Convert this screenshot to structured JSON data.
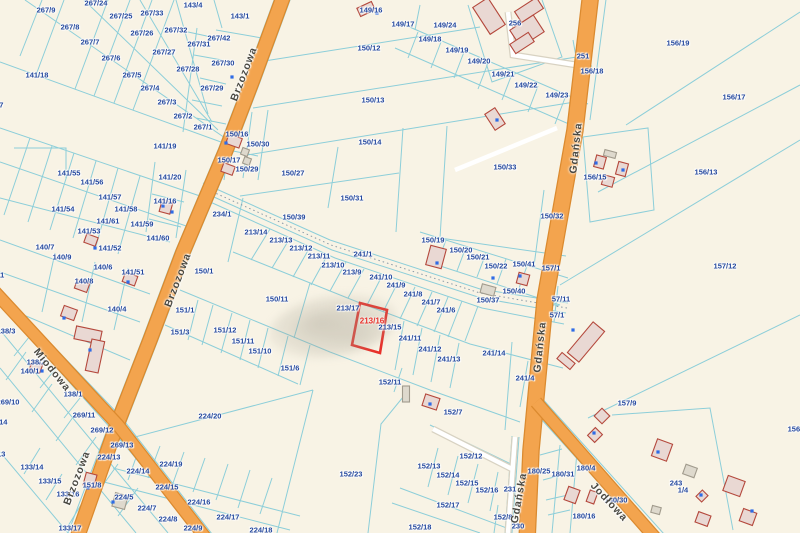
{
  "map": {
    "colors": {
      "background": "#f8f3e5",
      "boundary_line": "#8cced9",
      "parcel_label": "#24489e",
      "street_label": "#4a4942",
      "road_fill": "#f3a44e",
      "road_edge": "#db8a2f",
      "highlight": "#e8312a",
      "building_fill": "#e9d8d3",
      "building_stroke": "#b4483c",
      "shed_fill": "#ded9cd",
      "shed_stroke": "#a19b8d",
      "address_dot": "#2e6be6"
    },
    "highlight": {
      "label": "213/16",
      "points": "360,303 387,310 380,353 352,345",
      "label_x": 372,
      "label_y": 321
    },
    "streets": [
      {
        "t": "Brzozowa",
        "x": 244,
        "y": 74,
        "r": -69
      },
      {
        "t": "Brzozowa",
        "x": 178,
        "y": 280,
        "r": -69
      },
      {
        "t": "Brzozowa",
        "x": 77,
        "y": 478,
        "r": -69
      },
      {
        "t": "Gdańska",
        "x": 576,
        "y": 148,
        "r": -84
      },
      {
        "t": "Gdańska",
        "x": 540,
        "y": 347,
        "r": -84
      },
      {
        "t": "Gdańska",
        "x": 519,
        "y": 498,
        "r": -80
      },
      {
        "t": "Miodowa",
        "x": 52,
        "y": 370,
        "r": 51
      },
      {
        "t": "Jodłowa",
        "x": 609,
        "y": 502,
        "r": 47
      }
    ],
    "roads": [
      {
        "name": "Brzozowa",
        "path": "M285,-8 L252,82 L226,150 L183,252 L150,340 L115,430 L76,541",
        "width": 13
      },
      {
        "name": "Gdańska",
        "path": "M591,-8 L575,130 L545,300 L531,450 L527,541",
        "width": 15
      },
      {
        "name": "Miodowa",
        "path": "M-6,291 L118,425 L208,541",
        "width": 11
      },
      {
        "name": "Jodłowa",
        "path": "M536,402 L658,541",
        "width": 11
      }
    ],
    "parcel_labels": [
      {
        "t": "267/24",
        "x": 96,
        "y": 3
      },
      {
        "t": "267/9",
        "x": 46,
        "y": 10
      },
      {
        "t": "267/33",
        "x": 152,
        "y": 13
      },
      {
        "t": "267/25",
        "x": 121,
        "y": 16
      },
      {
        "t": "267/8",
        "x": 70,
        "y": 27
      },
      {
        "t": "267/32",
        "x": 176,
        "y": 30
      },
      {
        "t": "267/26",
        "x": 142,
        "y": 33
      },
      {
        "t": "267/7",
        "x": 90,
        "y": 42
      },
      {
        "t": "267/27",
        "x": 164,
        "y": 52
      },
      {
        "t": "267/6",
        "x": 111,
        "y": 58
      },
      {
        "t": "267/28",
        "x": 188,
        "y": 69
      },
      {
        "t": "267/5",
        "x": 132,
        "y": 75
      },
      {
        "t": "267/4",
        "x": 150,
        "y": 88
      },
      {
        "t": "267/3",
        "x": 167,
        "y": 102
      },
      {
        "t": "267/2",
        "x": 183,
        "y": 116
      },
      {
        "t": "143/4",
        "x": 193,
        "y": 5
      },
      {
        "t": "143/1",
        "x": 240,
        "y": 16
      },
      {
        "t": "267/42",
        "x": 219,
        "y": 38
      },
      {
        "t": "267/31",
        "x": 199,
        "y": 44
      },
      {
        "t": "267/30",
        "x": 223,
        "y": 63
      },
      {
        "t": "267/29",
        "x": 212,
        "y": 88
      },
      {
        "t": "267/1",
        "x": 203,
        "y": 127
      },
      {
        "t": "141/18",
        "x": 37,
        "y": 75
      },
      {
        "t": "141/27",
        "x": -8,
        "y": 105
      },
      {
        "t": "149/16",
        "x": 371,
        "y": 10
      },
      {
        "t": "150/12",
        "x": 369,
        "y": 48
      },
      {
        "t": "150/13",
        "x": 373,
        "y": 100
      },
      {
        "t": "150/14",
        "x": 370,
        "y": 142
      },
      {
        "t": "149/17",
        "x": 403,
        "y": 24
      },
      {
        "t": "149/24",
        "x": 445,
        "y": 25
      },
      {
        "t": "149/18",
        "x": 430,
        "y": 39
      },
      {
        "t": "149/19",
        "x": 457,
        "y": 50
      },
      {
        "t": "149/20",
        "x": 479,
        "y": 61
      },
      {
        "t": "149/21",
        "x": 503,
        "y": 74
      },
      {
        "t": "149/22",
        "x": 526,
        "y": 85
      },
      {
        "t": "149/23",
        "x": 557,
        "y": 95
      },
      {
        "t": "256",
        "x": 515,
        "y": 23
      },
      {
        "t": "251",
        "x": 583,
        "y": 56
      },
      {
        "t": "156/18",
        "x": 592,
        "y": 71
      },
      {
        "t": "156/19",
        "x": 678,
        "y": 43
      },
      {
        "t": "156/17",
        "x": 734,
        "y": 97
      },
      {
        "t": "156/13",
        "x": 706,
        "y": 172
      },
      {
        "t": "156/15",
        "x": 595,
        "y": 177
      },
      {
        "t": "157/12",
        "x": 725,
        "y": 266
      },
      {
        "t": "157/1",
        "x": 551,
        "y": 268
      },
      {
        "t": "150/16",
        "x": 237,
        "y": 134
      },
      {
        "t": "150/30",
        "x": 258,
        "y": 144
      },
      {
        "t": "150/17",
        "x": 229,
        "y": 160
      },
      {
        "t": "150/29",
        "x": 247,
        "y": 169
      },
      {
        "t": "150/27",
        "x": 293,
        "y": 173
      },
      {
        "t": "150/31",
        "x": 352,
        "y": 198
      },
      {
        "t": "150/33",
        "x": 505,
        "y": 167
      },
      {
        "t": "150/32",
        "x": 552,
        "y": 216
      },
      {
        "t": "234/1",
        "x": 222,
        "y": 214
      },
      {
        "t": "150/39",
        "x": 294,
        "y": 217
      },
      {
        "t": "150/1",
        "x": 204,
        "y": 271
      },
      {
        "t": "141/19",
        "x": 165,
        "y": 146
      },
      {
        "t": "141/55",
        "x": 69,
        "y": 173
      },
      {
        "t": "141/56",
        "x": 92,
        "y": 182
      },
      {
        "t": "141/57",
        "x": 110,
        "y": 197
      },
      {
        "t": "141/58",
        "x": 126,
        "y": 209
      },
      {
        "t": "141/20",
        "x": 170,
        "y": 177
      },
      {
        "t": "141/16",
        "x": 165,
        "y": 201
      },
      {
        "t": "141/54",
        "x": 63,
        "y": 209
      },
      {
        "t": "141/61",
        "x": 108,
        "y": 221
      },
      {
        "t": "141/59",
        "x": 142,
        "y": 224
      },
      {
        "t": "141/60",
        "x": 158,
        "y": 238
      },
      {
        "t": "141/53",
        "x": 89,
        "y": 231
      },
      {
        "t": "141/52",
        "x": 110,
        "y": 248
      },
      {
        "t": "140/7",
        "x": 45,
        "y": 247
      },
      {
        "t": "140/9",
        "x": 62,
        "y": 257
      },
      {
        "t": "140/6",
        "x": 103,
        "y": 267
      },
      {
        "t": "141/51",
        "x": 133,
        "y": 272
      },
      {
        "t": "140/8",
        "x": 84,
        "y": 281
      },
      {
        "t": "140/11",
        "x": -7,
        "y": 275
      },
      {
        "t": "213/14",
        "x": 256,
        "y": 232
      },
      {
        "t": "213/13",
        "x": 281,
        "y": 240
      },
      {
        "t": "213/12",
        "x": 301,
        "y": 248
      },
      {
        "t": "213/11",
        "x": 319,
        "y": 256
      },
      {
        "t": "213/10",
        "x": 333,
        "y": 265
      },
      {
        "t": "213/9",
        "x": 352,
        "y": 272
      },
      {
        "t": "241/1",
        "x": 363,
        "y": 254
      },
      {
        "t": "241/10",
        "x": 381,
        "y": 277
      },
      {
        "t": "241/9",
        "x": 396,
        "y": 285
      },
      {
        "t": "241/8",
        "x": 413,
        "y": 294
      },
      {
        "t": "241/7",
        "x": 431,
        "y": 302
      },
      {
        "t": "241/6",
        "x": 446,
        "y": 310
      },
      {
        "t": "150/19",
        "x": 433,
        "y": 240
      },
      {
        "t": "150/20",
        "x": 461,
        "y": 250
      },
      {
        "t": "150/21",
        "x": 478,
        "y": 257
      },
      {
        "t": "150/22",
        "x": 496,
        "y": 266
      },
      {
        "t": "150/41",
        "x": 524,
        "y": 264
      },
      {
        "t": "150/37",
        "x": 488,
        "y": 300
      },
      {
        "t": "150/40",
        "x": 514,
        "y": 291
      },
      {
        "t": "57/11",
        "x": 561,
        "y": 299
      },
      {
        "t": "57/1",
        "x": 557,
        "y": 315
      },
      {
        "t": "241/4",
        "x": 525,
        "y": 378
      },
      {
        "t": "150/11",
        "x": 277,
        "y": 299
      },
      {
        "t": "213/17",
        "x": 348,
        "y": 308
      },
      {
        "t": "213/15",
        "x": 390,
        "y": 327
      },
      {
        "t": "241/11",
        "x": 410,
        "y": 338
      },
      {
        "t": "241/12",
        "x": 430,
        "y": 349
      },
      {
        "t": "241/13",
        "x": 449,
        "y": 359
      },
      {
        "t": "241/14",
        "x": 494,
        "y": 353
      },
      {
        "t": "151/1",
        "x": 185,
        "y": 310
      },
      {
        "t": "151/3",
        "x": 180,
        "y": 332
      },
      {
        "t": "151/12",
        "x": 225,
        "y": 330
      },
      {
        "t": "151/11",
        "x": 243,
        "y": 341
      },
      {
        "t": "151/10",
        "x": 260,
        "y": 351
      },
      {
        "t": "151/6",
        "x": 290,
        "y": 368
      },
      {
        "t": "152/11",
        "x": 390,
        "y": 382
      },
      {
        "t": "152/7",
        "x": 453,
        "y": 412
      },
      {
        "t": "152/12",
        "x": 471,
        "y": 456
      },
      {
        "t": "152/13",
        "x": 429,
        "y": 466
      },
      {
        "t": "152/14",
        "x": 448,
        "y": 475
      },
      {
        "t": "152/15",
        "x": 467,
        "y": 483
      },
      {
        "t": "152/16",
        "x": 487,
        "y": 490
      },
      {
        "t": "152/17",
        "x": 448,
        "y": 505
      },
      {
        "t": "152/18",
        "x": 420,
        "y": 527
      },
      {
        "t": "152/8",
        "x": 503,
        "y": 517
      },
      {
        "t": "231",
        "x": 510,
        "y": 489
      },
      {
        "t": "230",
        "x": 518,
        "y": 526
      },
      {
        "t": "152/23",
        "x": 351,
        "y": 474
      },
      {
        "t": "224/20",
        "x": 210,
        "y": 416
      },
      {
        "t": "138/3",
        "x": 6,
        "y": 331
      },
      {
        "t": "140/4",
        "x": 117,
        "y": 309
      },
      {
        "t": "138/2",
        "x": 36,
        "y": 362
      },
      {
        "t": "140/1",
        "x": 30,
        "y": 371
      },
      {
        "t": "138/1",
        "x": 73,
        "y": 394
      },
      {
        "t": "269/10",
        "x": 8,
        "y": 402
      },
      {
        "t": "269/11",
        "x": 84,
        "y": 415
      },
      {
        "t": "269/12",
        "x": 102,
        "y": 430
      },
      {
        "t": "269/13",
        "x": 122,
        "y": 445
      },
      {
        "t": "269/14",
        "x": -4,
        "y": 422
      },
      {
        "t": "133/13",
        "x": -6,
        "y": 454
      },
      {
        "t": "133/14",
        "x": 32,
        "y": 467
      },
      {
        "t": "133/15",
        "x": 50,
        "y": 481
      },
      {
        "t": "133/16",
        "x": 68,
        "y": 494
      },
      {
        "t": "133/17",
        "x": 70,
        "y": 528
      },
      {
        "t": "224/13",
        "x": 109,
        "y": 457
      },
      {
        "t": "224/14",
        "x": 138,
        "y": 471
      },
      {
        "t": "224/19",
        "x": 171,
        "y": 464
      },
      {
        "t": "224/15",
        "x": 167,
        "y": 487
      },
      {
        "t": "151/8",
        "x": 92,
        "y": 485
      },
      {
        "t": "224/5",
        "x": 124,
        "y": 497
      },
      {
        "t": "224/7",
        "x": 147,
        "y": 508
      },
      {
        "t": "224/8",
        "x": 168,
        "y": 519
      },
      {
        "t": "224/9",
        "x": 193,
        "y": 528
      },
      {
        "t": "224/16",
        "x": 199,
        "y": 502
      },
      {
        "t": "224/17",
        "x": 228,
        "y": 517
      },
      {
        "t": "224/18",
        "x": 261,
        "y": 530
      },
      {
        "t": "157/9",
        "x": 627,
        "y": 403
      },
      {
        "t": "243",
        "x": 676,
        "y": 483
      },
      {
        "t": "180/25",
        "x": 539,
        "y": 471
      },
      {
        "t": "180/31",
        "x": 563,
        "y": 474
      },
      {
        "t": "180/4",
        "x": 586,
        "y": 468
      },
      {
        "t": "180/30",
        "x": 616,
        "y": 500
      },
      {
        "t": "180/16",
        "x": 584,
        "y": 516
      },
      {
        "t": "156/1",
        "x": 797,
        "y": 429
      },
      {
        "t": "1/4",
        "x": 683,
        "y": 490
      }
    ],
    "buildings": [
      {
        "x": 489,
        "y": 16,
        "w": 18,
        "h": 32,
        "r": -33,
        "k": "red"
      },
      {
        "x": 529,
        "y": 10,
        "w": 26,
        "h": 13,
        "r": -33,
        "k": "red"
      },
      {
        "x": 527,
        "y": 31,
        "w": 28,
        "h": 20,
        "r": -33,
        "k": "red"
      },
      {
        "x": 522,
        "y": 43,
        "w": 22,
        "h": 11,
        "r": -33,
        "k": "red"
      },
      {
        "x": 495,
        "y": 119,
        "w": 12,
        "h": 19,
        "r": -33,
        "k": "red"
      },
      {
        "x": 366,
        "y": 9,
        "w": 16,
        "h": 9,
        "r": -25,
        "k": "red"
      },
      {
        "x": 234,
        "y": 141,
        "w": 14,
        "h": 10,
        "r": 20,
        "k": "red"
      },
      {
        "x": 228,
        "y": 169,
        "w": 12,
        "h": 9,
        "r": 20,
        "k": "red"
      },
      {
        "x": 245,
        "y": 152,
        "w": 7,
        "h": 7,
        "r": 20,
        "k": "gray"
      },
      {
        "x": 247,
        "y": 161,
        "w": 7,
        "h": 7,
        "r": 20,
        "k": "gray"
      },
      {
        "x": 166,
        "y": 207,
        "w": 11,
        "h": 12,
        "r": 15,
        "k": "red"
      },
      {
        "x": 91,
        "y": 240,
        "w": 12,
        "h": 9,
        "r": 20,
        "k": "red"
      },
      {
        "x": 130,
        "y": 279,
        "w": 13,
        "h": 10,
        "r": 20,
        "k": "red"
      },
      {
        "x": 82,
        "y": 286,
        "w": 13,
        "h": 9,
        "r": 20,
        "k": "red"
      },
      {
        "x": 69,
        "y": 313,
        "w": 14,
        "h": 11,
        "r": 20,
        "k": "red"
      },
      {
        "x": 36,
        "y": 367,
        "w": 11,
        "h": 9,
        "r": 20,
        "k": "red"
      },
      {
        "x": 88,
        "y": 335,
        "w": 26,
        "h": 13,
        "r": 12,
        "k": "red"
      },
      {
        "x": 95,
        "y": 356,
        "w": 13,
        "h": 32,
        "r": 12,
        "k": "red"
      },
      {
        "x": 436,
        "y": 257,
        "w": 16,
        "h": 20,
        "r": 15,
        "k": "red"
      },
      {
        "x": 523,
        "y": 279,
        "w": 11,
        "h": 11,
        "r": 15,
        "k": "red"
      },
      {
        "x": 488,
        "y": 290,
        "w": 14,
        "h": 9,
        "r": 15,
        "k": "gray"
      },
      {
        "x": 586,
        "y": 342,
        "w": 40,
        "h": 15,
        "r": -50,
        "k": "red"
      },
      {
        "x": 566,
        "y": 361,
        "w": 8,
        "h": 17,
        "r": -50,
        "k": "red"
      },
      {
        "x": 600,
        "y": 162,
        "w": 10,
        "h": 12,
        "r": 15,
        "k": "red"
      },
      {
        "x": 622,
        "y": 169,
        "w": 10,
        "h": 13,
        "r": 15,
        "k": "red"
      },
      {
        "x": 608,
        "y": 181,
        "w": 11,
        "h": 10,
        "r": 15,
        "k": "red"
      },
      {
        "x": 610,
        "y": 154,
        "w": 12,
        "h": 6,
        "r": 15,
        "k": "gray"
      },
      {
        "x": 431,
        "y": 402,
        "w": 15,
        "h": 12,
        "r": 18,
        "k": "red"
      },
      {
        "x": 406,
        "y": 394,
        "w": 7,
        "h": 16,
        "r": 0,
        "k": "gray"
      },
      {
        "x": 120,
        "y": 501,
        "w": 13,
        "h": 14,
        "r": 15,
        "k": "gray"
      },
      {
        "x": 90,
        "y": 480,
        "w": 11,
        "h": 13,
        "r": 15,
        "k": "red"
      },
      {
        "x": 602,
        "y": 416,
        "w": 11,
        "h": 11,
        "r": 45,
        "k": "red"
      },
      {
        "x": 595,
        "y": 435,
        "w": 10,
        "h": 11,
        "r": 45,
        "k": "red"
      },
      {
        "x": 702,
        "y": 496,
        "w": 8,
        "h": 9,
        "r": 45,
        "k": "red"
      },
      {
        "x": 656,
        "y": 510,
        "w": 9,
        "h": 7,
        "r": 15,
        "k": "gray"
      },
      {
        "x": 662,
        "y": 450,
        "w": 16,
        "h": 18,
        "r": 20,
        "k": "red"
      },
      {
        "x": 690,
        "y": 471,
        "w": 12,
        "h": 10,
        "r": 20,
        "k": "gray"
      },
      {
        "x": 734,
        "y": 486,
        "w": 18,
        "h": 16,
        "r": 20,
        "k": "red"
      },
      {
        "x": 703,
        "y": 519,
        "w": 13,
        "h": 11,
        "r": 20,
        "k": "red"
      },
      {
        "x": 748,
        "y": 517,
        "w": 14,
        "h": 13,
        "r": 20,
        "k": "red"
      },
      {
        "x": 572,
        "y": 495,
        "w": 12,
        "h": 14,
        "r": 20,
        "k": "red"
      },
      {
        "x": 592,
        "y": 497,
        "w": 8,
        "h": 12,
        "r": 20,
        "k": "red"
      }
    ],
    "address_dots": [
      [
        232,
        77
      ],
      [
        377,
        13
      ],
      [
        497,
        120
      ],
      [
        226,
        143
      ],
      [
        172,
        212
      ],
      [
        95,
        248
      ],
      [
        128,
        282
      ],
      [
        64,
        318
      ],
      [
        42,
        371
      ],
      [
        90,
        350
      ],
      [
        437,
        263
      ],
      [
        493,
        278
      ],
      [
        520,
        276
      ],
      [
        573,
        330
      ],
      [
        430,
        404
      ],
      [
        113,
        502
      ],
      [
        594,
        433
      ],
      [
        701,
        495
      ],
      [
        658,
        452
      ],
      [
        752,
        511
      ],
      [
        596,
        163
      ],
      [
        623,
        170
      ],
      [
        88,
        488
      ],
      [
        163,
        206
      ]
    ]
  }
}
